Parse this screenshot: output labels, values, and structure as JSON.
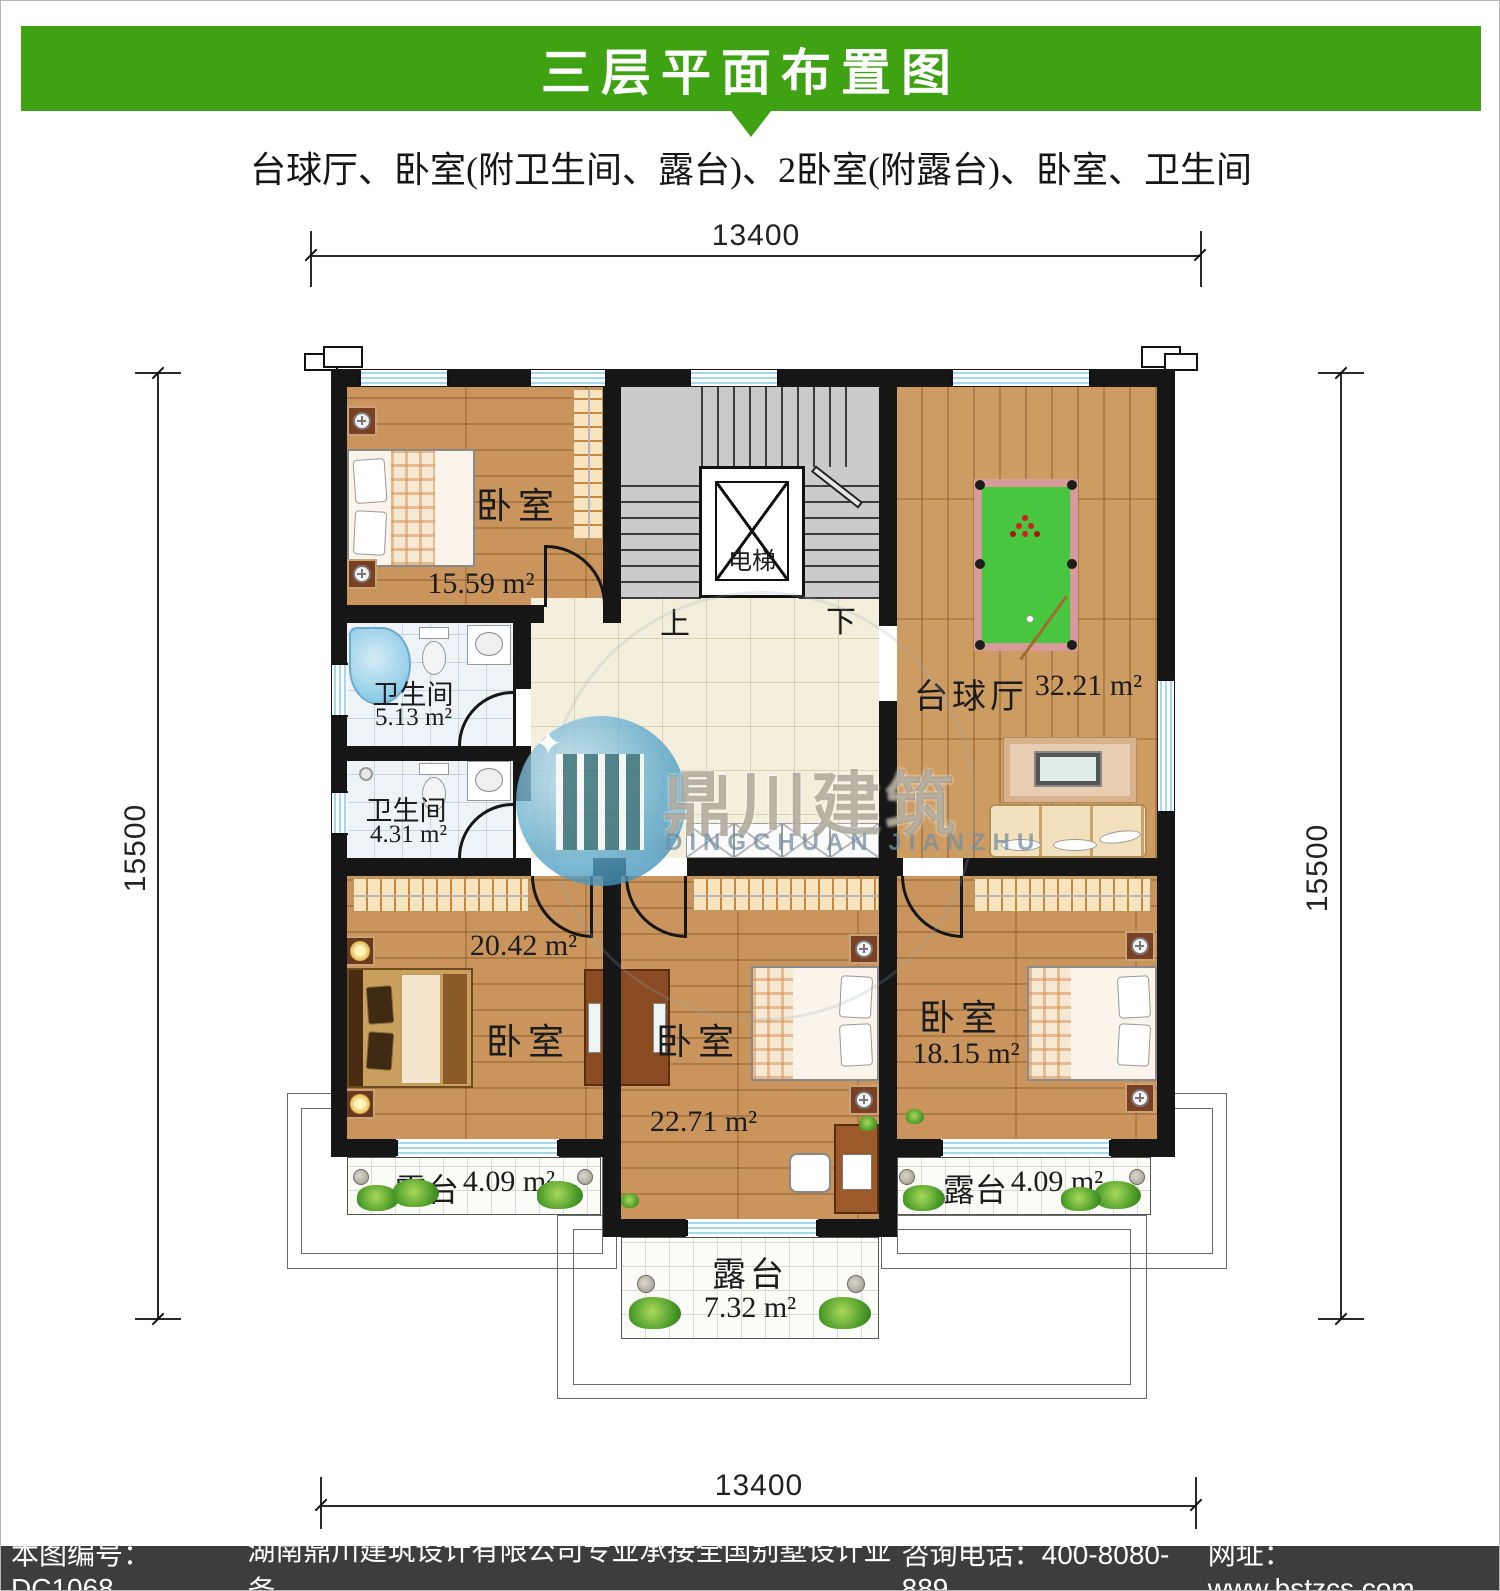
{
  "header": {
    "title": "三层平面布置图",
    "subtitle": "台球厅、卧室(附卫生间、露台)、2卧室(附露台)、卧室、卫生间",
    "bar_color": "#3fa212"
  },
  "dimensions": {
    "top": "13400",
    "bottom": "13400",
    "left": "15500",
    "right": "15500"
  },
  "rooms": {
    "bedroom_top": {
      "label": "卧室",
      "area": "15.59 m²"
    },
    "bath_upper": {
      "label": "卫生间",
      "area": "5.13 m²"
    },
    "bath_lower": {
      "label": "卫生间",
      "area": "4.31 m²"
    },
    "billiard": {
      "label": "台球厅",
      "area": "32.21 m²"
    },
    "bedroom_left": {
      "label": "卧室",
      "area": "20.42 m²"
    },
    "bedroom_mid": {
      "label": "卧室",
      "area": "22.71 m²"
    },
    "bedroom_right": {
      "label": "卧室",
      "area": "18.15 m²"
    },
    "elevator": {
      "label": "电梯"
    },
    "stairs": {
      "up": "上",
      "down": "下"
    },
    "terrace_left": {
      "label": "露台",
      "area": "4.09 m²"
    },
    "terrace_right": {
      "label": "露台",
      "area": "4.09 m²"
    },
    "terrace_bottom": {
      "label": "露台",
      "area": "7.32 m²"
    }
  },
  "watermark": {
    "cn": "鼎川建筑",
    "en": "DINGCHUAN JIANZHU"
  },
  "footer": {
    "plan_no": "本图编号：DC1068",
    "company": "湖南鼎川建筑设计有限公司专业承接全国别墅设计业务",
    "phone": "咨询电话：400-8080-889",
    "website": "网址：www.bstzcs.com"
  },
  "palette": {
    "banner_green": "#3fa212",
    "wall_black": "#161616",
    "wood": "#c58d50",
    "pool_felt": "#49c63f",
    "pool_rail": "#d79b9b",
    "window_blue": "#a5d8ec",
    "footer_gray": "#3d3d3d"
  }
}
